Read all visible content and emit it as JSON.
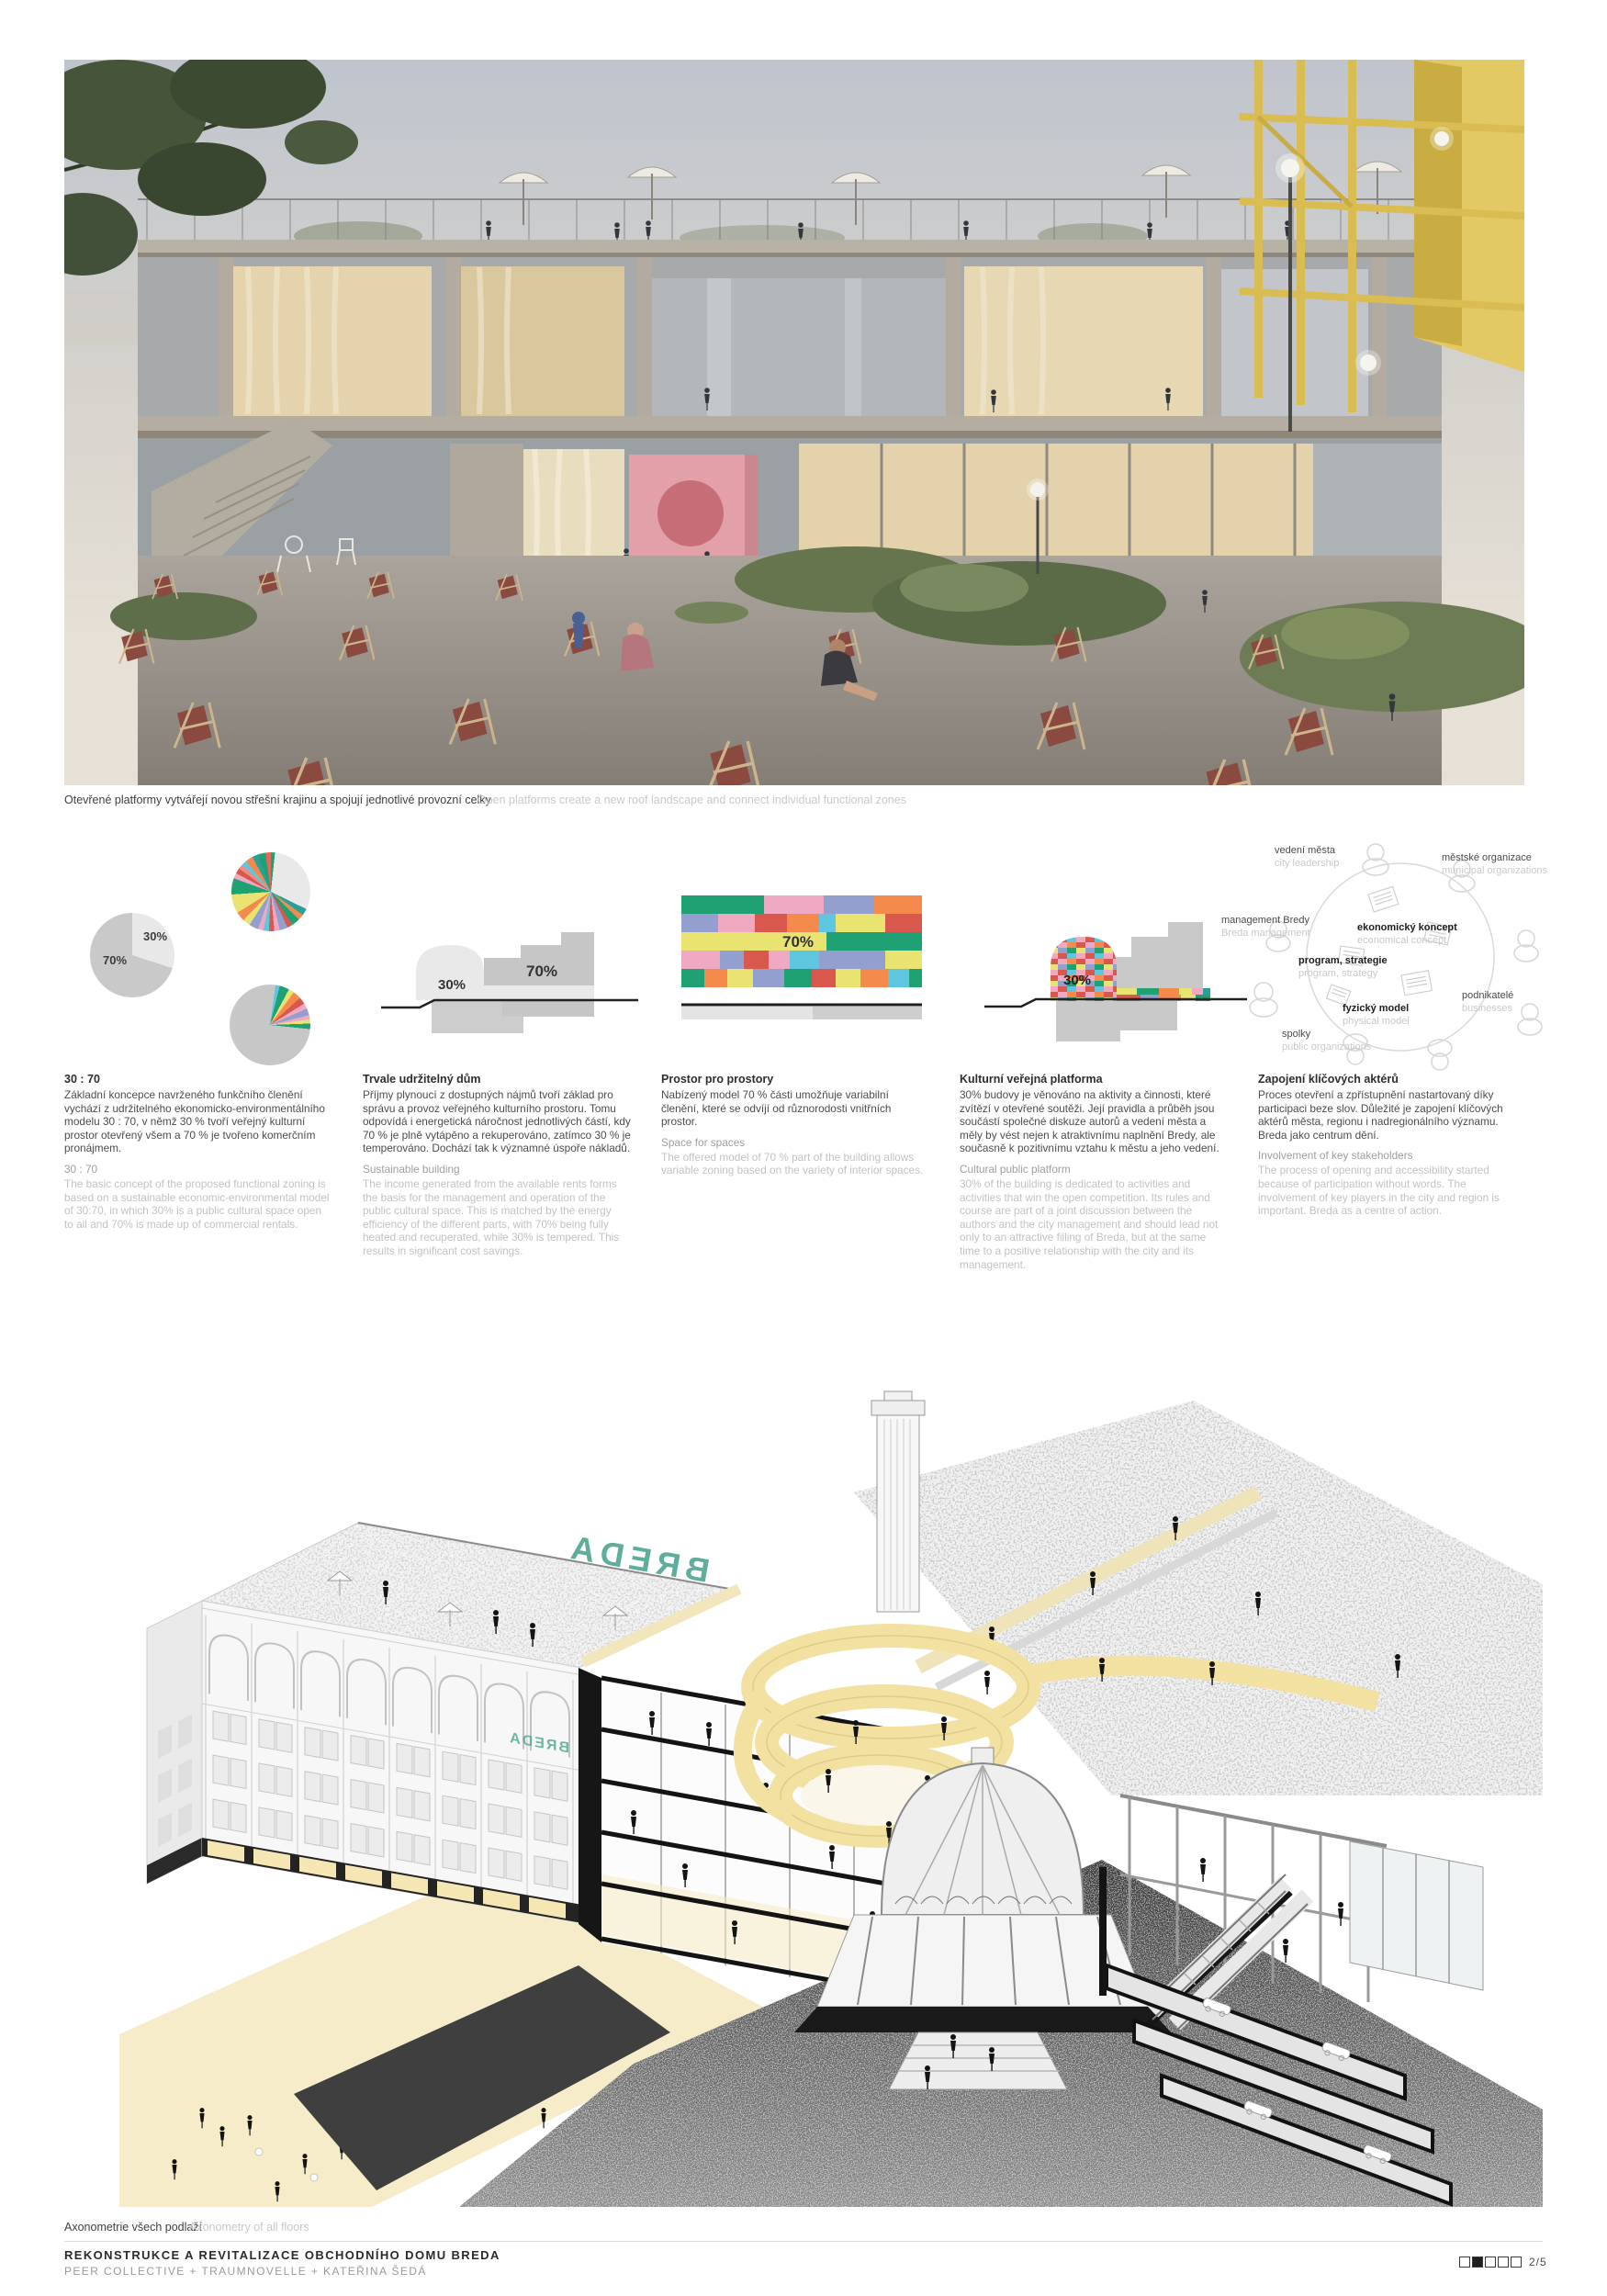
{
  "hero": {
    "caption_cs": "Otevřené platformy vytvářejí novou střešní krajinu a spojují jednotlivé provozní celky",
    "caption_en": "Open platforms create a new roof landscape and connect individual functional zones"
  },
  "diagrams": {
    "pie_gray": {
      "label_30": "30%",
      "label_70": "70%"
    },
    "section_gray": {
      "label_30": "30%",
      "label_70": "70%"
    },
    "mosaic": {
      "label": "70%"
    },
    "section_color": {
      "label": "30%"
    },
    "network": {
      "items": [
        {
          "cs": "vedení města",
          "en": "city leadership"
        },
        {
          "cs": "městské organizace",
          "en": "municipal organizations"
        },
        {
          "cs": "management Bredy",
          "en": "Breda management"
        },
        {
          "cs": "ekonomický koncept",
          "en": "economical concept"
        },
        {
          "cs": "program, strategie",
          "en": "program, strategy"
        },
        {
          "cs": "fyzický model",
          "en": "physical model"
        },
        {
          "cs": "podnikatelé",
          "en": "businesses"
        },
        {
          "cs": "spolky",
          "en": "public organizations"
        }
      ]
    }
  },
  "columns": [
    {
      "title_cs": "30 : 70",
      "body_cs": "Základní koncepce navrženého funkčního členění vychází z udržitelného ekonomicko-environmentálního modelu 30 : 70, v němž 30 % tvoří veřejný kulturní prostor otevřený všem a 70 % je tvořeno komerčním pronájmem.",
      "title_en": "30 : 70",
      "body_en": "The basic concept of the proposed functional zoning is based on a sustainable economic-environmental model of 30:70, in which 30% is a public cultural space open to all and 70% is made up of commercial rentals."
    },
    {
      "title_cs": "Trvale udržitelný dům",
      "body_cs": "Příjmy plynoucí z dostupných nájmů tvoří základ pro správu a provoz veřejného kulturního prostoru. Tomu odpovídá i energetická náročnost jednotlivých částí, kdy 70 % je plně vytápěno a rekuperováno, zatímco 30 % je temperováno. Dochází tak k významné úspoře nákladů.",
      "title_en": "Sustainable building",
      "body_en": "The income generated from the available rents forms the basis for the management and operation of the public cultural space. This is matched by the energy efficiency of the different parts, with 70% being fully heated and recuperated, while 30% is tempered. This results in significant cost savings."
    },
    {
      "title_cs": "Prostor pro prostory",
      "body_cs": "Nabízený model 70 % části umožňuje variabilní členění, které se odvíjí od různorodosti vnitřních prostor.",
      "title_en": "Space for spaces",
      "body_en": "The offered model of 70 % part of the building allows variable zoning based on the variety of interior spaces."
    },
    {
      "title_cs": "Kulturní veřejná platforma",
      "body_cs": "30% budovy je věnováno na aktivity a činnosti, které zvítězí v otevřené soutěži. Její pravidla a průběh jsou součástí společné diskuze autorů a vedení města a měly by vést nejen k atraktivnímu naplnění Bredy, ale současně k pozitivnímu vztahu k městu a jeho vedení.",
      "title_en": "Cultural public platform",
      "body_en": "30% of the building is dedicated to activities and activities that win the open competition. Its rules and course are part of a joint discussion between the authors and the city management and should lead not only to an attractive filling of Breda, but at the same time to a positive relationship with the city and its management."
    },
    {
      "title_cs": "Zapojení klíčových aktérů",
      "body_cs": "Proces otevření a zpřístupnění nastartovaný díky participaci beze slov. Důležité je zapojení klíčových aktérů města, regionu i nadregionálního významu. Breda jako centrum dění.",
      "title_en": "Involvement of key stakeholders",
      "body_en": "The process of opening and accessibility started because of participation without words. The involvement of key players in the city and region is important. Breda as a centre of action."
    }
  ],
  "axon": {
    "sign": "BREDA",
    "caption_cs": "Axonometrie všech podlaží",
    "caption_en": "Axonometry of all floors"
  },
  "footer": {
    "title": "REKONSTRUKCE A REVITALIZACE OBCHODNÍHO DOMU BREDA",
    "authors": "PEER COLLECTIVE + TRAUMNOVELLE + KATEŘINA ŠEDÁ",
    "page": "2/5"
  },
  "palette": {
    "green": "#1fa174",
    "teal": "#2aa198",
    "pink": "#f0a9c3",
    "periwinkle": "#93a0cf",
    "orange": "#f58a4d",
    "red": "#d8584e",
    "yellow": "#e9e472",
    "cyan": "#5fc6e0",
    "ramp_yellow": "#f3e1a2",
    "sign_teal": "#5fae9b",
    "gray_light": "#e8e8e8",
    "gray_mid": "#c9c9c9",
    "ink": "#1a1a1a"
  },
  "chart_data": [
    {
      "type": "pie",
      "id": "functional-split",
      "labels": [
        "veřejný kulturní prostor / public cultural space",
        "komerční pronájem / commercial rentals"
      ],
      "values": [
        30,
        70
      ],
      "unit": "%",
      "colors": [
        "#e8e8e8",
        "#c9c9c9"
      ]
    },
    {
      "type": "pie",
      "id": "tenant-mix-of-70",
      "note": "many small commercial tenant slices (values estimated from drawing)",
      "values": [
        30,
        3,
        3,
        3,
        2,
        3,
        2,
        2,
        2,
        2,
        4,
        3,
        4,
        8,
        7,
        2,
        2,
        2,
        2,
        3,
        3,
        3,
        2,
        3
      ],
      "unit": "%"
    },
    {
      "type": "pie",
      "id": "tenant-mix-of-30",
      "note": "mostly gray with small colored slices (values estimated)",
      "values": [
        73,
        2,
        4,
        2,
        3,
        3,
        2,
        3,
        2,
        2,
        2,
        2
      ],
      "unit": "%"
    },
    {
      "type": "section-diagram",
      "id": "section-gray",
      "labels": {
        "dome": "30%",
        "block": "70%"
      }
    },
    {
      "type": "mosaic",
      "id": "variable-zoning",
      "label": "70%",
      "rows": 5
    },
    {
      "type": "section-diagram",
      "id": "cultural-platform",
      "labels": {
        "dome": "30%"
      }
    }
  ]
}
